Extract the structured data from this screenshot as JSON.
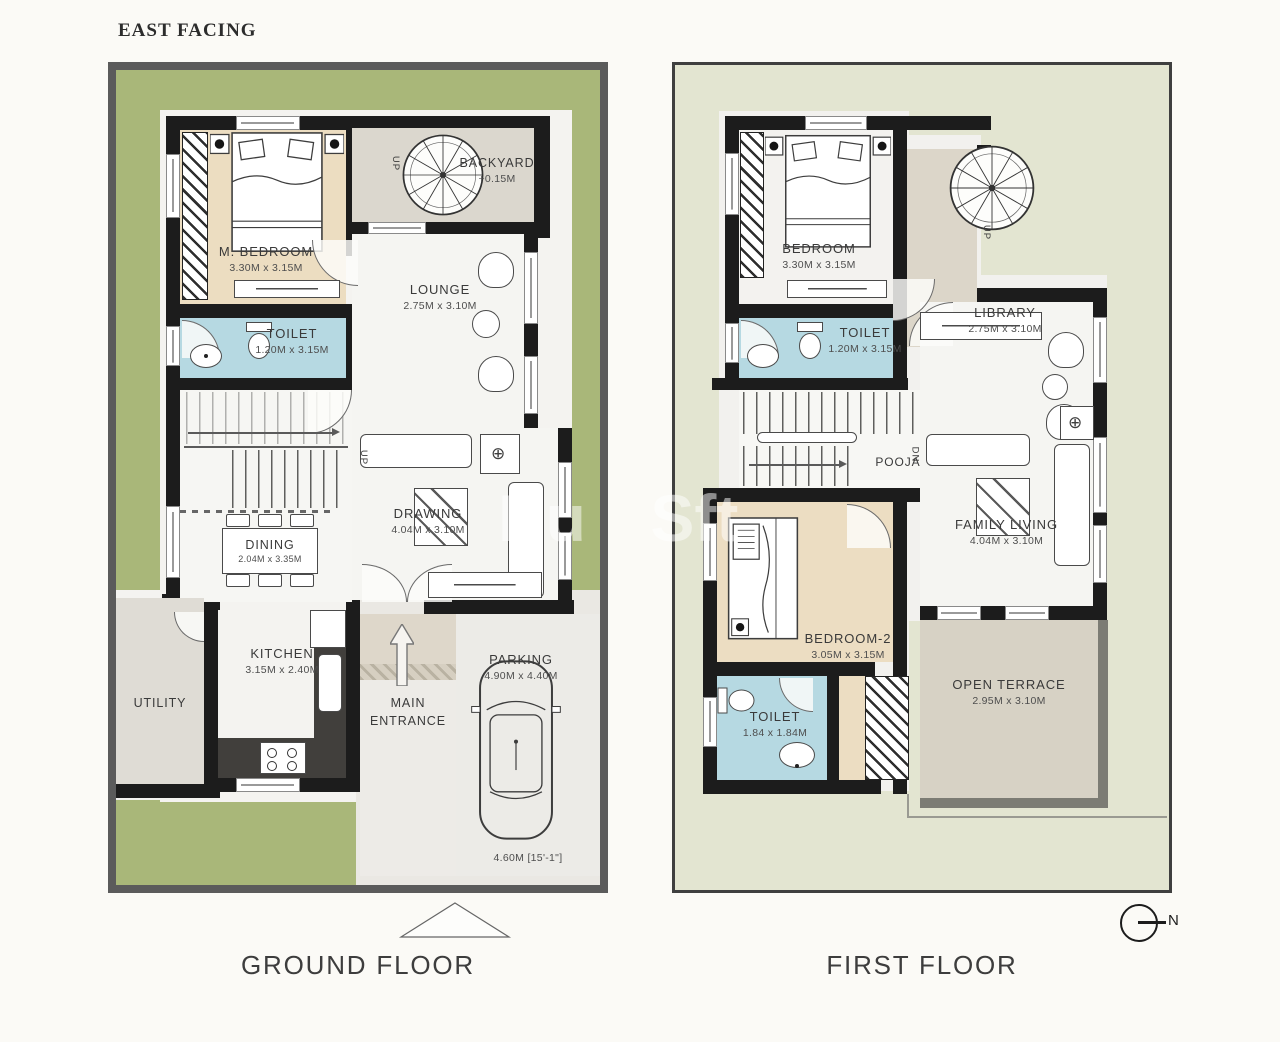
{
  "title": "EAST FACING",
  "watermark": "Bu Sft",
  "compass": {
    "label": "N"
  },
  "icons": {
    "fan": "⊕"
  },
  "colors": {
    "yard_green": "#a9b779",
    "wall_black": "#1c1c1c",
    "toilet_blue": "#b6d9e2",
    "bedroom_tan": "#ecddc1",
    "terrace_gray": "#d7d2c5",
    "frame_gray": "#5b5b5b",
    "first_floor_bg": "#e3e5d1"
  },
  "floors": {
    "ground": {
      "label": "GROUND FLOOR",
      "m_bedroom": {
        "name": "M. BEDROOM",
        "dims": "3.30M x 3.15M"
      },
      "backyard": {
        "name": "BACKYARD",
        "level": "+0.15M"
      },
      "lounge": {
        "name": "LOUNGE",
        "dims": "2.75M x 3.10M"
      },
      "toilet": {
        "name": "TOILET",
        "dims": "1.20M x 3.15M"
      },
      "dining": {
        "name": "DINING",
        "dims": "2.04M x 3.35M"
      },
      "drawing": {
        "name": "DRAWING",
        "dims": "4.04M x 3.10M"
      },
      "kitchen": {
        "name": "KITCHEN",
        "dims": "3.15M x 2.40M"
      },
      "utility": {
        "name": "UTILITY"
      },
      "entrance": {
        "name": "MAIN ENTRANCE"
      },
      "parking": {
        "name": "PARKING",
        "dims": "4.90M x 4.40M",
        "width_note": "4.60M [15'-1\"]"
      },
      "stair_up": "UP",
      "spiral_up": "UP"
    },
    "first": {
      "label": "FIRST FLOOR",
      "bedroom": {
        "name": "BEDROOM",
        "dims": "3.30M x 3.15M"
      },
      "toilet": {
        "name": "TOILET",
        "dims": "1.20M x 3.15M"
      },
      "library": {
        "name": "LIBRARY",
        "dims": "2.75M x 3.10M"
      },
      "pooja": {
        "name": "POOJA"
      },
      "family_living": {
        "name": "FAMILY LIVING",
        "dims": "4.04M x 3.10M"
      },
      "bedroom2": {
        "name": "BEDROOM-2",
        "dims": "3.05M x 3.15M"
      },
      "toilet2": {
        "name": "TOILET",
        "dims": "1.84 x 1.84M"
      },
      "open_terrace": {
        "name": "OPEN TERRACE",
        "dims": "2.95M x 3.10M"
      },
      "stair_dn": "DN",
      "spiral_up": "UP"
    }
  }
}
